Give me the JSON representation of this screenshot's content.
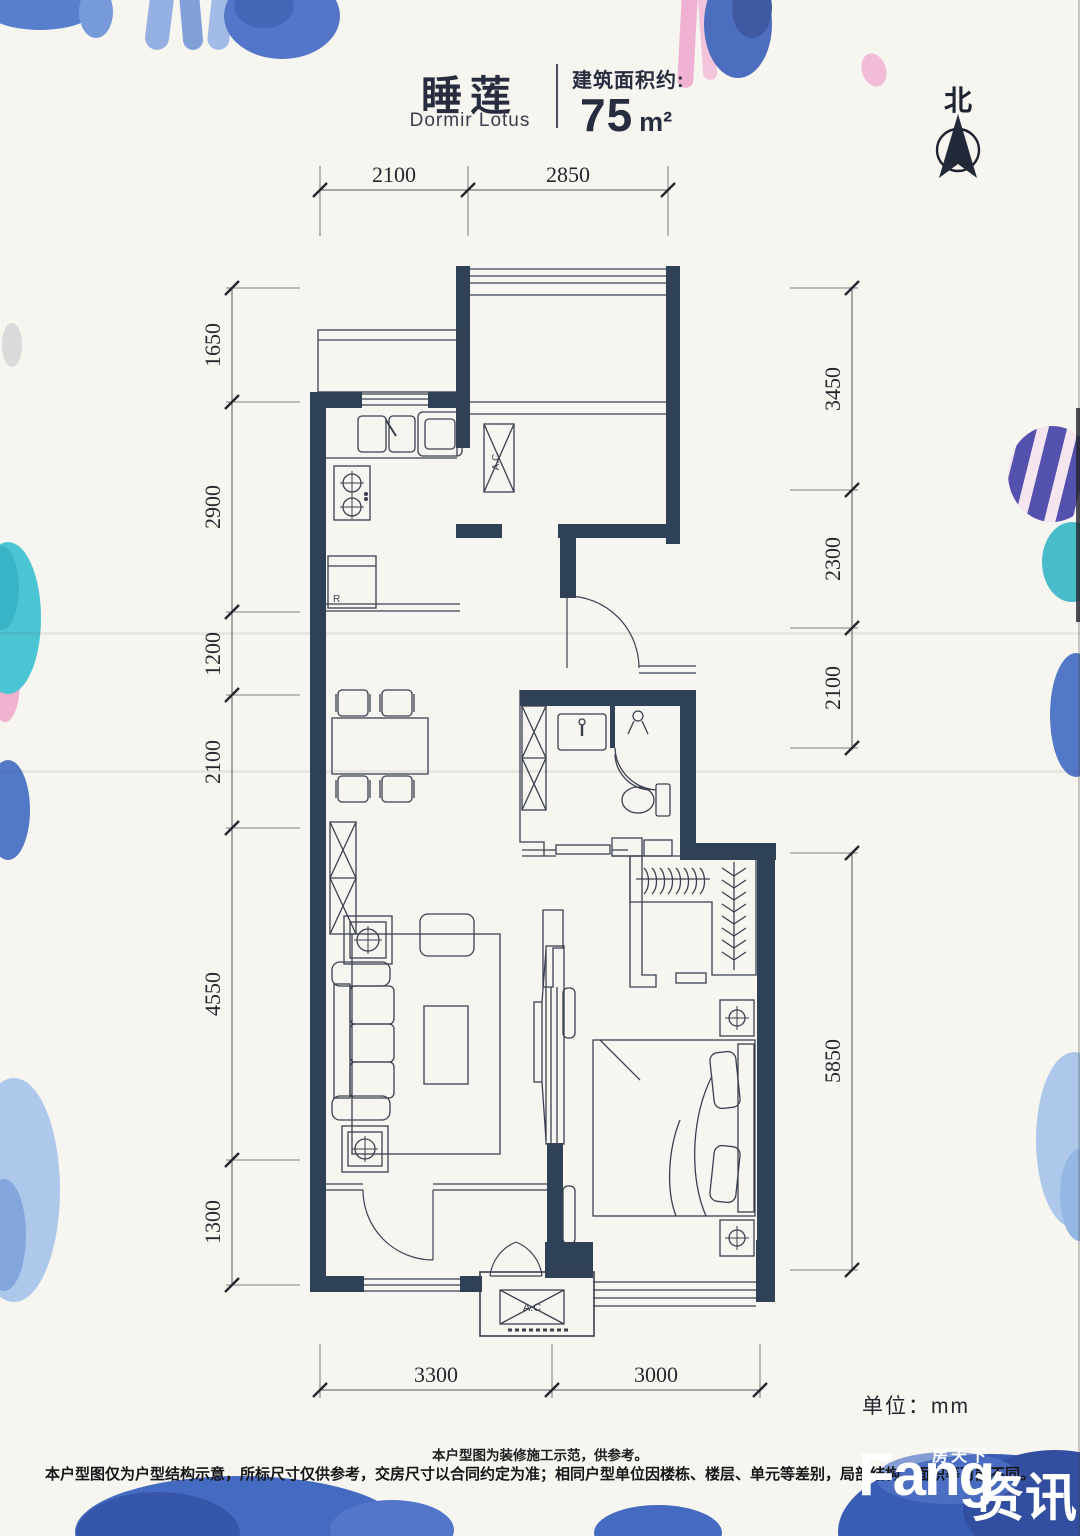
{
  "header": {
    "title_cn": "睡莲",
    "title_en": "Dormir Lotus",
    "area_label": "建筑面积约:",
    "area_value": "75",
    "area_unit": "m²"
  },
  "compass": {
    "north_label": "北"
  },
  "plan_labels": {
    "ac_indoor": "A.C",
    "ac_outdoor": "A.C",
    "fridge": "R"
  },
  "dimensions": {
    "top": [
      "2100",
      "2850"
    ],
    "left": [
      "1650",
      "2900",
      "1200",
      "2100",
      "4550",
      "1300"
    ],
    "right_upper": [
      "3450",
      "2300",
      "2100"
    ],
    "right_lower": [
      "5850"
    ],
    "bottom": [
      "3300",
      "3000"
    ],
    "unit_label": "单位：mm"
  },
  "footer": {
    "note_line1": "本户型图为装修施工示范，供参考。",
    "note_line2": "本户型图仅为户型结构示意，所标尺寸仅供参考，交房尺寸以合同约定为准；相同户型单位因楼栋、楼层、单元等差别，局部结构、面积等可能不同。"
  },
  "watermark": {
    "brand_small": "房天下",
    "brand_main": "Fang",
    "brand_cn": "资讯"
  },
  "colors": {
    "wall": "#2e4156",
    "line": "#3a4050",
    "paper": "#f7f5f0",
    "blue": "#3f68c0",
    "light_blue": "#a9c6ea",
    "teal": "#3fbfcc",
    "pink": "#f0aecd",
    "indigo": "#4b49aa"
  }
}
